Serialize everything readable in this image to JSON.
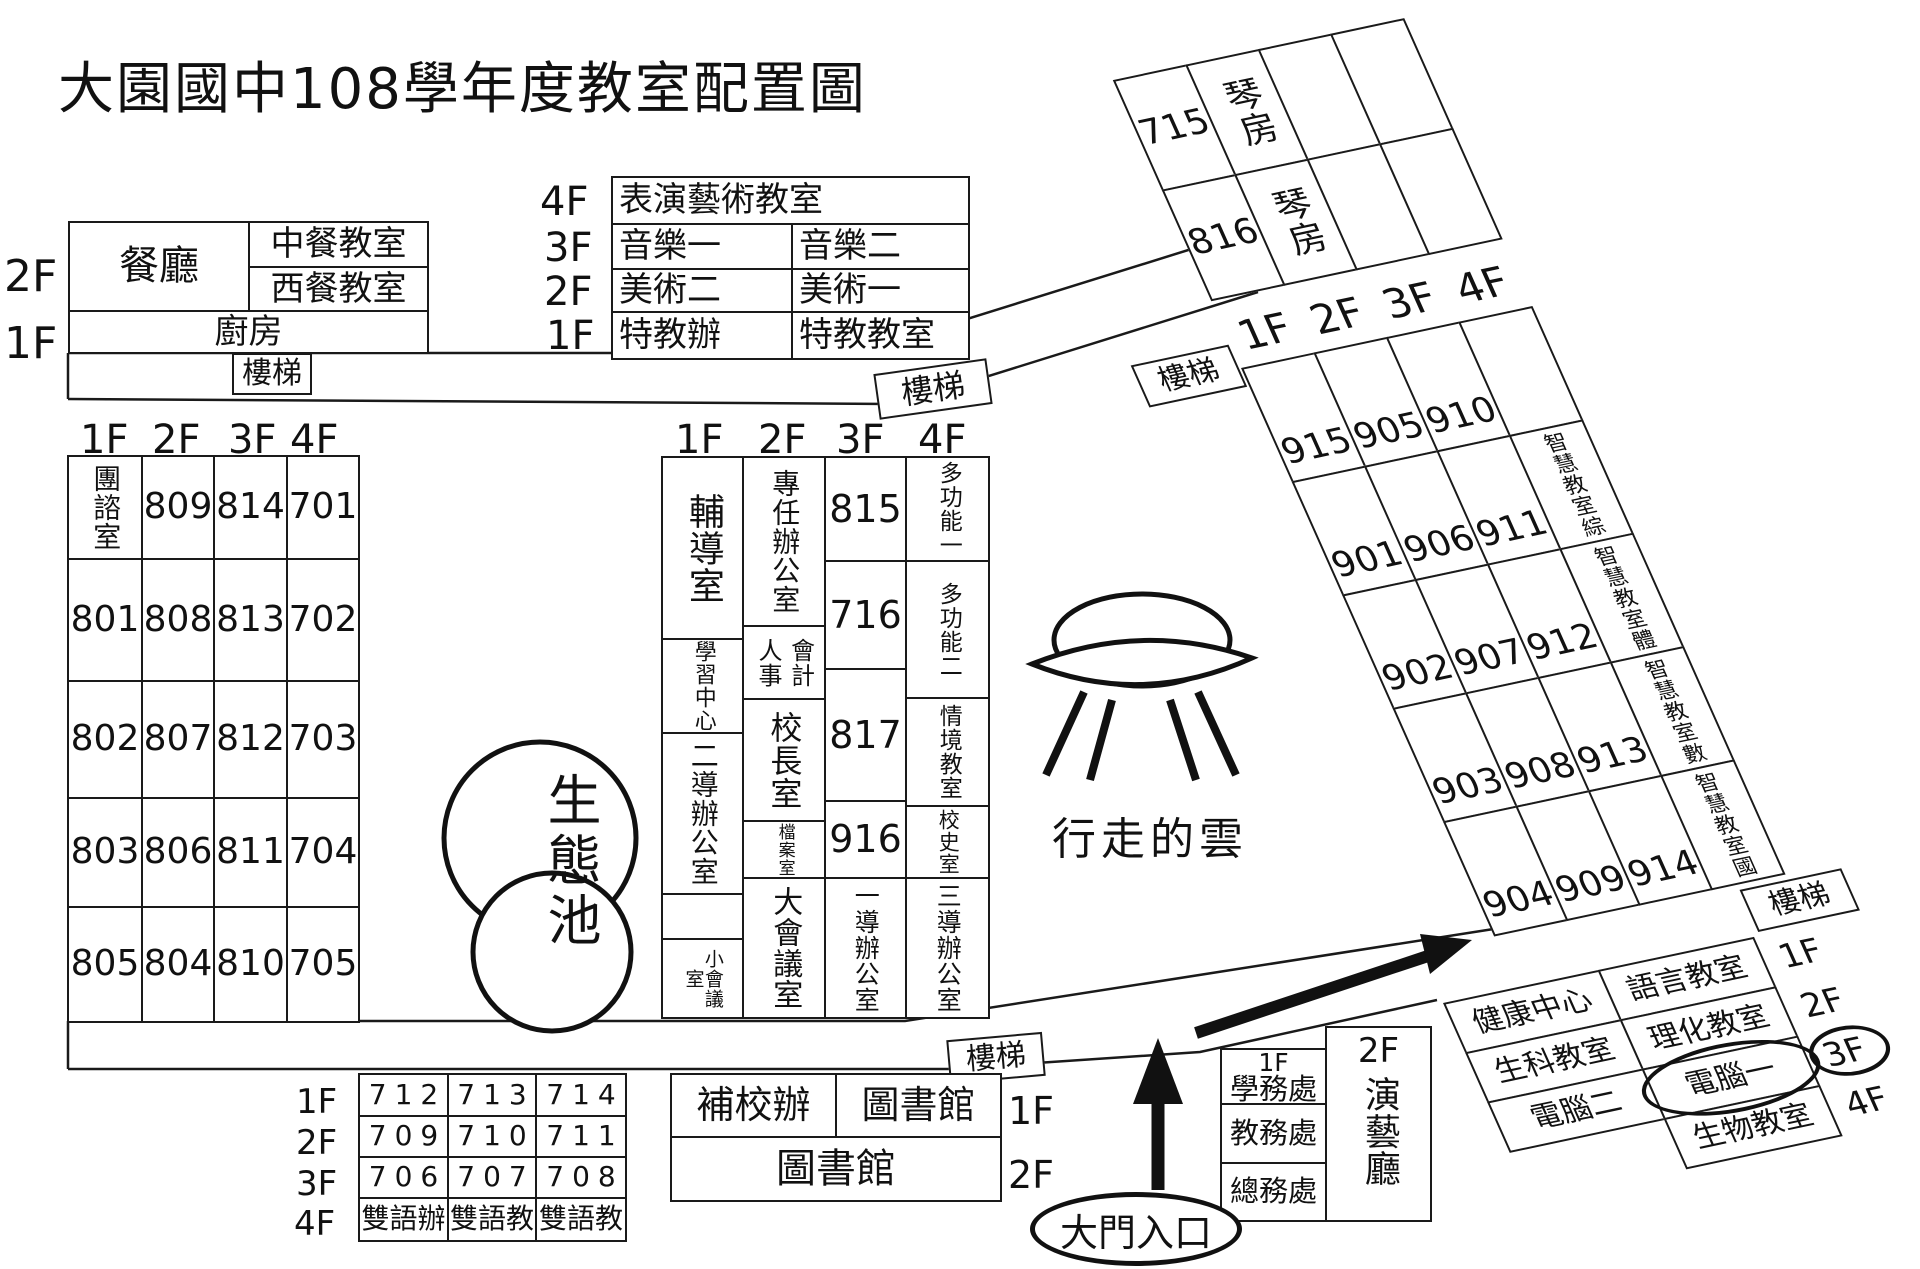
{
  "title": "大園國中108學年度教室配置圖",
  "stairs": "樓梯",
  "cafeteria": {
    "f2": "2F",
    "f1": "1F",
    "dining": "餐廳",
    "chinese": "中餐教室",
    "western": "西餐教室",
    "kitchen": "廚房"
  },
  "special_ed": {
    "f4": "4F",
    "f3": "3F",
    "f2": "2F",
    "f1": "1F",
    "performance": "表演藝術教室",
    "music1": "音樂一",
    "music2": "音樂二",
    "art2": "美術二",
    "art1": "美術一",
    "sped_office": "特教辦",
    "sped_room": "特教教室"
  },
  "west_grid": {
    "floors": [
      "1F",
      "2F",
      "3F",
      "4F"
    ],
    "rows": [
      [
        "團諮室",
        "809",
        "814",
        "701"
      ],
      [
        "801",
        "808",
        "813",
        "702"
      ],
      [
        "802",
        "807",
        "812",
        "703"
      ],
      [
        "803",
        "806",
        "811",
        "704"
      ],
      [
        "805",
        "804",
        "810",
        "705"
      ]
    ]
  },
  "admin": {
    "floors": [
      "1F",
      "2F",
      "3F",
      "4F"
    ],
    "counseling": "輔導室",
    "learning": "學習中心",
    "grade2_office": "二導辦公室",
    "small_meeting": "小會議室",
    "subject_office": "專任辦公室",
    "hr": "人事",
    "accounting": "會計",
    "principal": "校長室",
    "archives": "檔案室",
    "large_meeting": "大會議室",
    "r815": "815",
    "r716": "716",
    "r817": "817",
    "r916": "916",
    "grade1_office": "一導辦公室",
    "multi1": "多功能一",
    "multi2": "多功能二",
    "situational": "情境教室",
    "history": "校史室",
    "grade3_office": "三導辦公室"
  },
  "pond": "生態池",
  "sculpture": "行走的雲",
  "ne_building": {
    "floors": [
      "1F",
      "2F",
      "3F",
      "4F"
    ],
    "piano": [
      {
        "num": "715",
        "name": "琴房"
      },
      {
        "num": "816",
        "name": "琴房"
      }
    ],
    "grid": [
      [
        "915",
        "905",
        "910",
        ""
      ],
      [
        "901",
        "906",
        "911",
        "智慧教室綜"
      ],
      [
        "902",
        "907",
        "912",
        "智慧教室體"
      ],
      [
        "903",
        "908",
        "913",
        "智慧教室數"
      ],
      [
        "904",
        "909",
        "914",
        "智慧教室國"
      ]
    ]
  },
  "sw_grid": {
    "floors": [
      "1F",
      "2F",
      "3F",
      "4F"
    ],
    "rows": [
      [
        "712",
        "713",
        "714"
      ],
      [
        "709",
        "710",
        "711"
      ],
      [
        "706",
        "707",
        "708"
      ],
      [
        "雙語辦",
        "雙語教",
        "雙語教"
      ]
    ]
  },
  "library": {
    "night_school": "補校辦",
    "library1": "圖書館",
    "f1": "1F",
    "library2": "圖書館",
    "f2": "2F"
  },
  "offices": {
    "f1": "1F",
    "student": "學務處",
    "academic": "教務處",
    "general": "總務處",
    "f2": "2F",
    "hall": "演藝廳"
  },
  "se_building": {
    "floors": [
      "1F",
      "2F",
      "3F",
      "4F"
    ],
    "rows": [
      [
        "健康中心",
        "語言教室"
      ],
      [
        "生科教室",
        "理化教室"
      ],
      [
        "電腦二",
        "電腦一"
      ],
      [
        "",
        "生物教室"
      ]
    ]
  },
  "entrance": "大門入口"
}
